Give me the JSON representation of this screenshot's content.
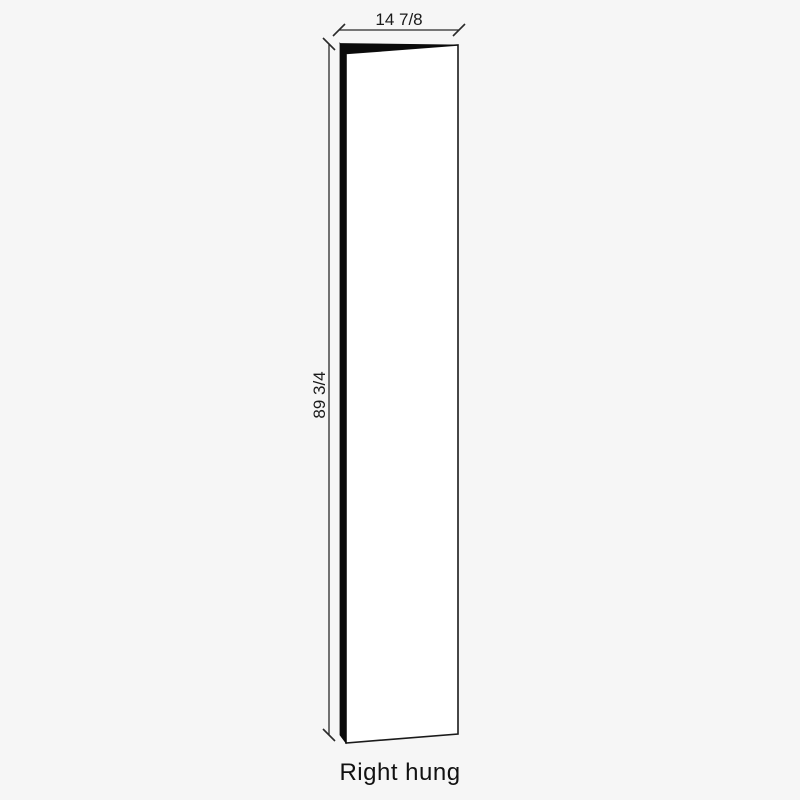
{
  "page": {
    "background": "#f6f6f6"
  },
  "diagram": {
    "caption": "Right hung",
    "dimensions": {
      "width": {
        "label": "14 7/8"
      },
      "height": {
        "label": "89 3/4"
      }
    },
    "colors": {
      "door_face": "#ffffff",
      "door_edge": "#0a0a0a",
      "outline": "#1a1a1a",
      "dimension_line": "#2a2a2a",
      "text": "#111111"
    }
  }
}
